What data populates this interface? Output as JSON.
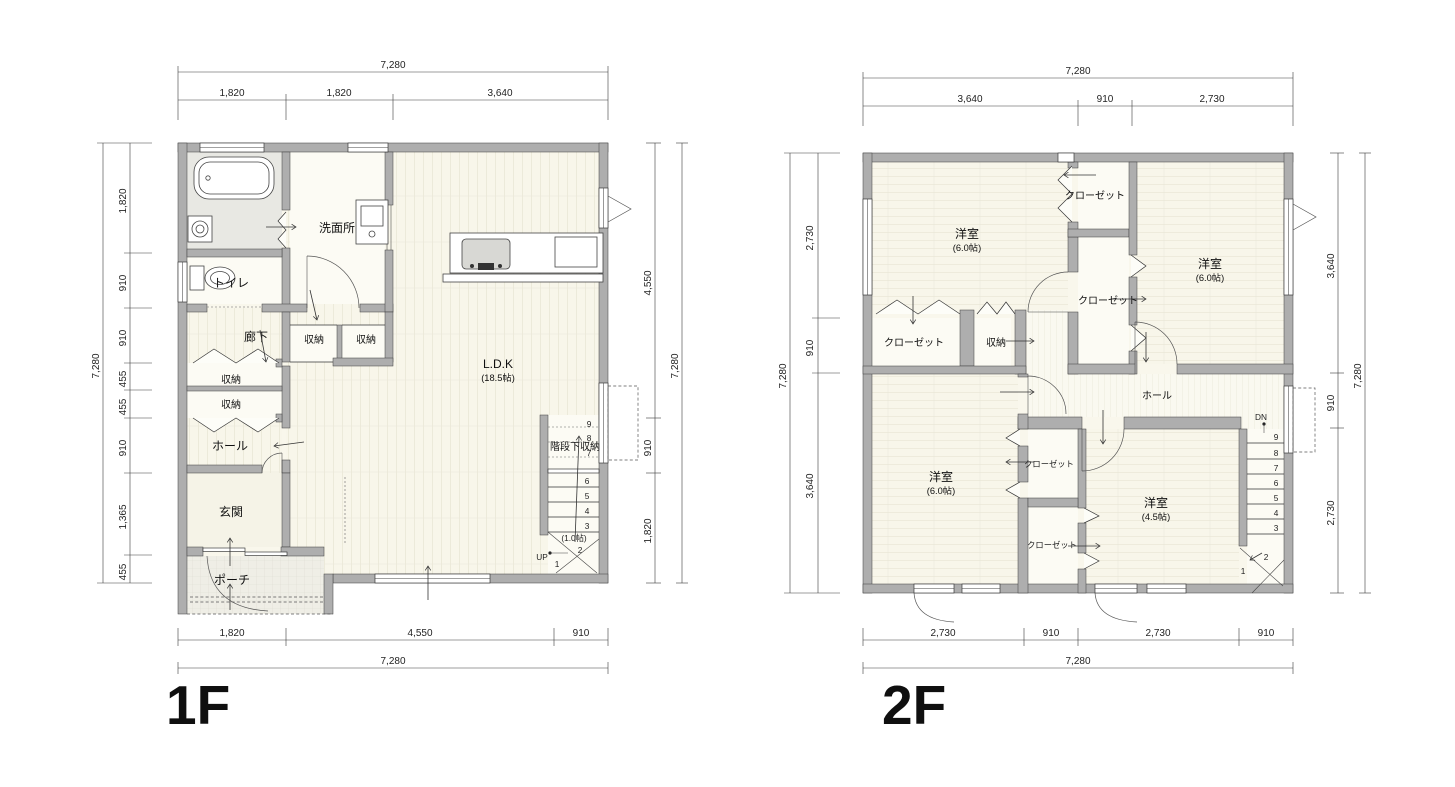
{
  "f1": {
    "label": "1F",
    "rooms": {
      "washroom": "洗面所",
      "toilet": "トイレ",
      "corridor": "廊下",
      "storage_mid_left": "収納",
      "storage_mid_right": "収納",
      "storage_left_upper": "収納",
      "storage_left_lower": "収納",
      "hall": "ホール",
      "entrance": "玄関",
      "porch": "ポーチ",
      "ldk": "L.D.K",
      "ldk_size": "(18.5帖)",
      "understair_storage": "階段下収納",
      "stair_size": "(1.0帖)",
      "up_label": "UP"
    },
    "stairs": [
      "9",
      "8",
      "7",
      "6",
      "5",
      "4",
      "3",
      "2",
      "1"
    ],
    "dims": {
      "top_total": "7,280",
      "top": [
        "1,820",
        "1,820",
        "3,640"
      ],
      "left_total": "7,280",
      "left": [
        "1,820",
        "910",
        "910",
        "455",
        "455",
        "910",
        "1,365",
        "455"
      ],
      "right": [
        "4,550",
        "910",
        "1,820"
      ],
      "right_total": "7,280",
      "bottom": [
        "1,820",
        "4,550",
        "910"
      ],
      "bottom_total": "7,280"
    }
  },
  "f2": {
    "label": "2F",
    "rooms": {
      "bedroom_nw": "洋室",
      "bedroom_nw_size": "(6.0帖)",
      "bedroom_ne": "洋室",
      "bedroom_ne_size": "(6.0帖)",
      "bedroom_sw": "洋室",
      "bedroom_sw_size": "(6.0帖)",
      "bedroom_se": "洋室",
      "bedroom_se_size": "(4.5帖)",
      "closet_north": "クローゼット",
      "closet_mid": "クローゼット",
      "closet_nw": "クローゼット",
      "storage": "収納",
      "hall": "ホール",
      "closet_sw": "クローゼット",
      "closet_se": "クローゼット",
      "dn_label": "DN"
    },
    "stairs": [
      "9",
      "8",
      "7",
      "6",
      "5",
      "4",
      "3",
      "2",
      "1"
    ],
    "dims": {
      "top_total": "7,280",
      "top": [
        "3,640",
        "910",
        "2,730"
      ],
      "left_total": "7,280",
      "left": [
        "2,730",
        "910",
        "3,640"
      ],
      "right": [
        "3,640",
        "910",
        "2,730"
      ],
      "right_total": "7,280",
      "bottom": [
        "2,730",
        "910",
        "2,730",
        "910"
      ],
      "bottom_total": "7,280"
    }
  },
  "colors": {
    "wall": "#aeaeae",
    "floor": "#f9f7ec",
    "bath_floor": "#e8e8e3",
    "line": "#333333"
  }
}
